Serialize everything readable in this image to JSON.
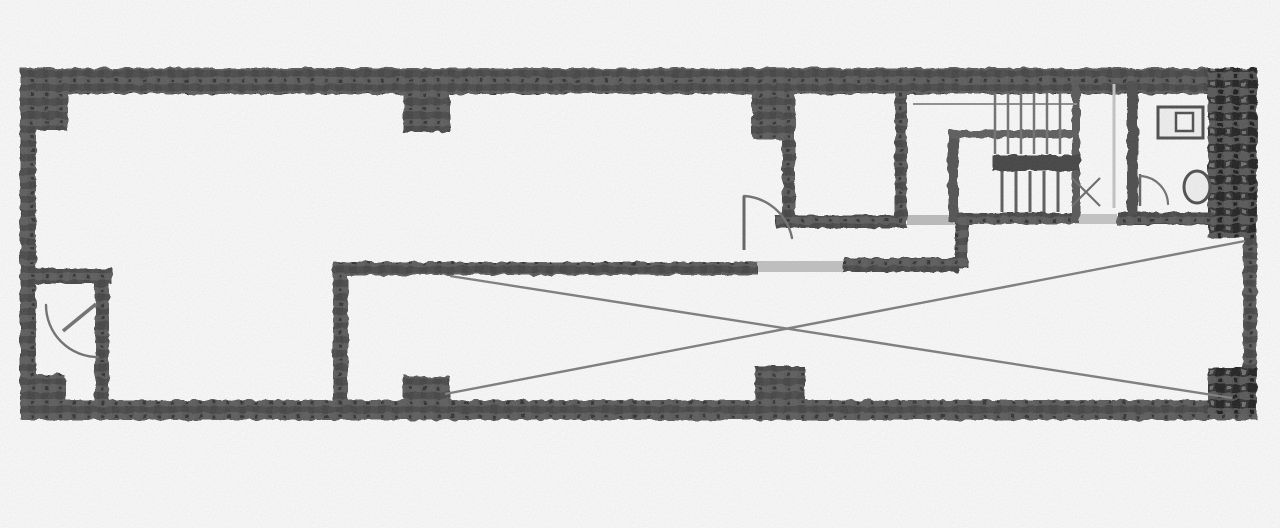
{
  "document": {
    "kind": "scanned-floor-plan",
    "canvas": {
      "w": 1280,
      "h": 528
    },
    "colors": {
      "paper": "#fdfdfd",
      "wall_base": "#4d4d4d",
      "wall_dark": "#3c3c3c",
      "partition": "#4a4a4a",
      "mid_line": "#7c7c7c",
      "tread_line": "#6f6f6f",
      "faint_line": "#c4c4c4",
      "fixture_stroke": "#4a4a4a",
      "fixture_fill": "#f2f2f2",
      "threshold": "#c2c2c2"
    }
  },
  "plan": {
    "walls": [
      {
        "name": "outer-wall-top",
        "x": 20,
        "y": 68,
        "w": 1237,
        "h": 26
      },
      {
        "name": "outer-wall-left",
        "x": 20,
        "y": 68,
        "w": 16,
        "h": 352
      },
      {
        "name": "outer-wall-bottom",
        "x": 20,
        "y": 400,
        "w": 1237,
        "h": 20
      },
      {
        "name": "outer-wall-right-lower",
        "x": 1243,
        "y": 230,
        "w": 14,
        "h": 190
      },
      {
        "name": "shaft-wall-right-upper",
        "x": 1208,
        "y": 68,
        "w": 49,
        "h": 170,
        "tex": "dark"
      },
      {
        "name": "corner-pillar-top-left",
        "x": 20,
        "y": 68,
        "w": 48,
        "h": 62
      },
      {
        "name": "pillar-top-a",
        "x": 403,
        "y": 68,
        "w": 47,
        "h": 64
      },
      {
        "name": "pillar-top-b",
        "x": 752,
        "y": 68,
        "w": 43,
        "h": 72
      },
      {
        "name": "pillar-bottom-a",
        "x": 403,
        "y": 376,
        "w": 47,
        "h": 40
      },
      {
        "name": "pillar-bottom-b",
        "x": 755,
        "y": 366,
        "w": 50,
        "h": 48
      },
      {
        "name": "pillar-bottom-right",
        "x": 1208,
        "y": 368,
        "w": 49,
        "h": 46,
        "tex": "dark"
      },
      {
        "name": "pillar-bottom-left",
        "x": 20,
        "y": 374,
        "w": 46,
        "h": 44
      },
      {
        "name": "wc-wall-top",
        "x": 20,
        "y": 268,
        "w": 92,
        "h": 16
      },
      {
        "name": "wc-wall-right",
        "x": 95,
        "y": 268,
        "w": 14,
        "h": 146
      },
      {
        "name": "void-wall-left",
        "x": 333,
        "y": 262,
        "w": 15,
        "h": 152
      },
      {
        "name": "void-wall-top-west",
        "x": 333,
        "y": 262,
        "w": 424,
        "h": 13
      },
      {
        "name": "void-wall-top-east",
        "x": 843,
        "y": 258,
        "w": 115,
        "h": 14
      },
      {
        "name": "step-wall-vertical",
        "x": 955,
        "y": 213,
        "w": 13,
        "h": 55
      },
      {
        "name": "stair-wall-south",
        "x": 962,
        "y": 213,
        "w": 115,
        "h": 11
      },
      {
        "name": "toilet-wall-south",
        "x": 1117,
        "y": 212,
        "w": 96,
        "h": 13
      },
      {
        "name": "elevator-wall-west",
        "x": 782,
        "y": 72,
        "w": 13,
        "h": 156
      },
      {
        "name": "elevator-wall-east",
        "x": 895,
        "y": 88,
        "w": 12,
        "h": 134
      },
      {
        "name": "elevator-wall-south",
        "x": 775,
        "y": 215,
        "w": 132,
        "h": 13
      },
      {
        "name": "toilet-partition-wall",
        "x": 1127,
        "y": 82,
        "w": 11,
        "h": 133,
        "fill": "#4a4a4a"
      },
      {
        "name": "stair-wall-east",
        "x": 1072,
        "y": 80,
        "w": 8,
        "h": 143,
        "fill": "#555555"
      },
      {
        "name": "stair-inner-wall-vertical",
        "x": 948,
        "y": 130,
        "w": 10,
        "h": 93,
        "fill": "#4f4f4f"
      },
      {
        "name": "stair-inner-wall-horizontal",
        "x": 948,
        "y": 130,
        "w": 132,
        "h": 8,
        "fill": "#5a5a5a"
      },
      {
        "name": "stair-mid-landing-wall",
        "x": 993,
        "y": 155,
        "w": 87,
        "h": 16,
        "fill": "#3f3f3f"
      }
    ],
    "thresholds": [
      {
        "name": "doorway-threshold-main",
        "x": 747,
        "y": 261,
        "w": 96,
        "h": 11,
        "fill": "#c2c2c2"
      },
      {
        "name": "doorway-threshold-stair",
        "x": 907,
        "y": 215,
        "w": 48,
        "h": 10,
        "fill": "#bcbcbc"
      },
      {
        "name": "doorway-threshold-toilet",
        "x": 1077,
        "y": 214,
        "w": 40,
        "h": 10,
        "fill": "#c6c6c6"
      }
    ],
    "lines": [
      {
        "name": "void-cross-diagonal-down",
        "x1": 450,
        "y1": 276,
        "x2": 1232,
        "y2": 398,
        "w": 2.4,
        "color": "#7c7c7c"
      },
      {
        "name": "void-cross-diagonal-up",
        "x1": 445,
        "y1": 394,
        "x2": 1245,
        "y2": 241,
        "w": 2.4,
        "color": "#7c7c7c"
      },
      {
        "name": "stair-rail-line",
        "x1": 913,
        "y1": 104,
        "x2": 1077,
        "y2": 104,
        "w": 2,
        "color": "#8e8e8e"
      },
      {
        "name": "stair-tread-upper-1",
        "x1": 995,
        "y1": 93,
        "x2": 995,
        "y2": 154,
        "w": 2.5,
        "color": "#6f6f6f"
      },
      {
        "name": "stair-tread-upper-2",
        "x1": 1008,
        "y1": 93,
        "x2": 1008,
        "y2": 154,
        "w": 2.5,
        "color": "#6f6f6f"
      },
      {
        "name": "stair-tread-upper-3",
        "x1": 1021,
        "y1": 93,
        "x2": 1021,
        "y2": 154,
        "w": 2.5,
        "color": "#6f6f6f"
      },
      {
        "name": "stair-tread-upper-4",
        "x1": 1034,
        "y1": 93,
        "x2": 1034,
        "y2": 154,
        "w": 2.5,
        "color": "#6f6f6f"
      },
      {
        "name": "stair-tread-upper-5",
        "x1": 1047,
        "y1": 93,
        "x2": 1047,
        "y2": 154,
        "w": 2.5,
        "color": "#6f6f6f"
      },
      {
        "name": "stair-tread-upper-6",
        "x1": 1060,
        "y1": 93,
        "x2": 1060,
        "y2": 154,
        "w": 2.5,
        "color": "#6f6f6f"
      },
      {
        "name": "stair-tread-lower-1",
        "x1": 1002,
        "y1": 171,
        "x2": 1002,
        "y2": 212,
        "w": 3,
        "color": "#595959"
      },
      {
        "name": "stair-tread-lower-2",
        "x1": 1016,
        "y1": 171,
        "x2": 1016,
        "y2": 212,
        "w": 3,
        "color": "#595959"
      },
      {
        "name": "stair-tread-lower-3",
        "x1": 1030,
        "y1": 171,
        "x2": 1030,
        "y2": 212,
        "w": 3,
        "color": "#595959"
      },
      {
        "name": "stair-tread-lower-4",
        "x1": 1044,
        "y1": 171,
        "x2": 1044,
        "y2": 212,
        "w": 3,
        "color": "#595959"
      },
      {
        "name": "stair-tread-lower-5",
        "x1": 1058,
        "y1": 171,
        "x2": 1058,
        "y2": 212,
        "w": 3,
        "color": "#595959"
      },
      {
        "name": "corridor-faint-line",
        "x1": 1114,
        "y1": 84,
        "x2": 1114,
        "y2": 208,
        "w": 3,
        "color": "#c4c4c4"
      },
      {
        "name": "main-door-leaf",
        "x1": 744,
        "y1": 196,
        "x2": 744,
        "y2": 250,
        "w": 3,
        "color": "#606060"
      },
      {
        "name": "wc-door-leaf",
        "x1": 96,
        "y1": 304,
        "x2": 63,
        "y2": 331,
        "w": 3.5,
        "color": "#6f6f6f"
      },
      {
        "name": "toilet-door-leaf",
        "x1": 1140,
        "y1": 174,
        "x2": 1140,
        "y2": 206,
        "w": 2.5,
        "color": "#606060"
      },
      {
        "name": "hatch-x-marker-1",
        "x1": 1072,
        "y1": 178,
        "x2": 1100,
        "y2": 206,
        "w": 2.2,
        "color": "#6a6a6a"
      },
      {
        "name": "hatch-x-marker-2",
        "x1": 1100,
        "y1": 178,
        "x2": 1072,
        "y2": 206,
        "w": 2.2,
        "color": "#6a6a6a"
      }
    ],
    "arcs": [
      {
        "name": "main-door-swing-arc",
        "d": "M 744 196 A 52 52 0 0 1 792 238",
        "w": 2.4,
        "color": "#6f6f6f"
      },
      {
        "name": "wc-door-swing-arc",
        "d": "M 46 305 A 52 52 0 0 0 98 357",
        "w": 2.4,
        "color": "#6f6f6f"
      },
      {
        "name": "toilet-door-swing-arc",
        "d": "M 1140 176 A 29 29 0 0 1 1168 204",
        "w": 2.2,
        "color": "#6f6f6f"
      }
    ],
    "fixtures": [
      {
        "name": "toilet-cistern-outline",
        "shape": "rect",
        "x": 1158,
        "y": 107,
        "w": 45,
        "h": 31,
        "stroke": "#4a4a4a",
        "sw": 3,
        "fill": "#f2f2f2"
      },
      {
        "name": "toilet-cistern-inner",
        "shape": "rect",
        "x": 1176,
        "y": 113,
        "w": 17,
        "h": 18,
        "stroke": "#4a4a4a",
        "sw": 2.5,
        "fill": "#fafafa"
      },
      {
        "name": "toilet-bowl",
        "shape": "ellipse",
        "cx": 1197,
        "cy": 187,
        "rx": 13,
        "ry": 16,
        "stroke": "#4a4a4a",
        "sw": 3,
        "fill": "#f2f2f2"
      }
    ]
  }
}
